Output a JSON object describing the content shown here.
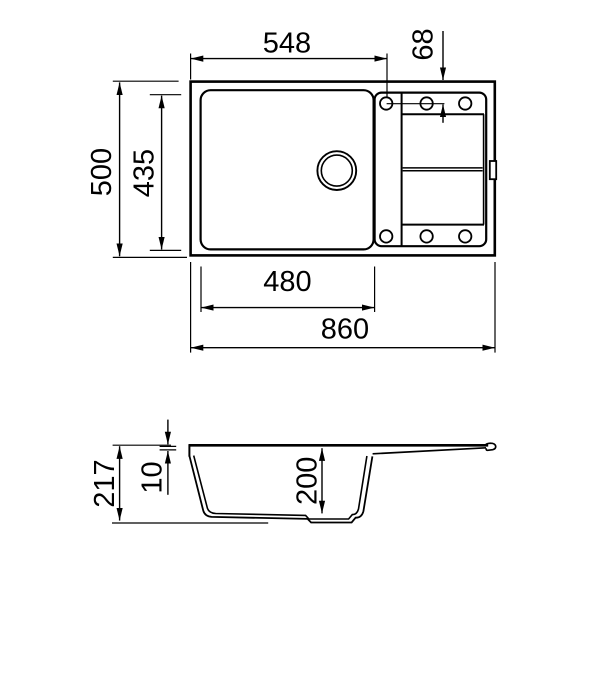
{
  "title": "Sink technical drawing",
  "colors": {
    "line": "#000000",
    "background": "#ffffff"
  },
  "views": {
    "top": {
      "name": "top-view",
      "tap_hole_count": 6,
      "dims": {
        "bowl_outer_width": "548",
        "tap_hole_offset": "68",
        "overall_depth": "500",
        "bowl_depth": "435",
        "bowl_inner_width": "480",
        "overall_width": "860"
      }
    },
    "side": {
      "name": "side-section-view",
      "dims": {
        "overall_height": "217",
        "rim_thickness": "10",
        "bowl_height": "200"
      }
    }
  }
}
